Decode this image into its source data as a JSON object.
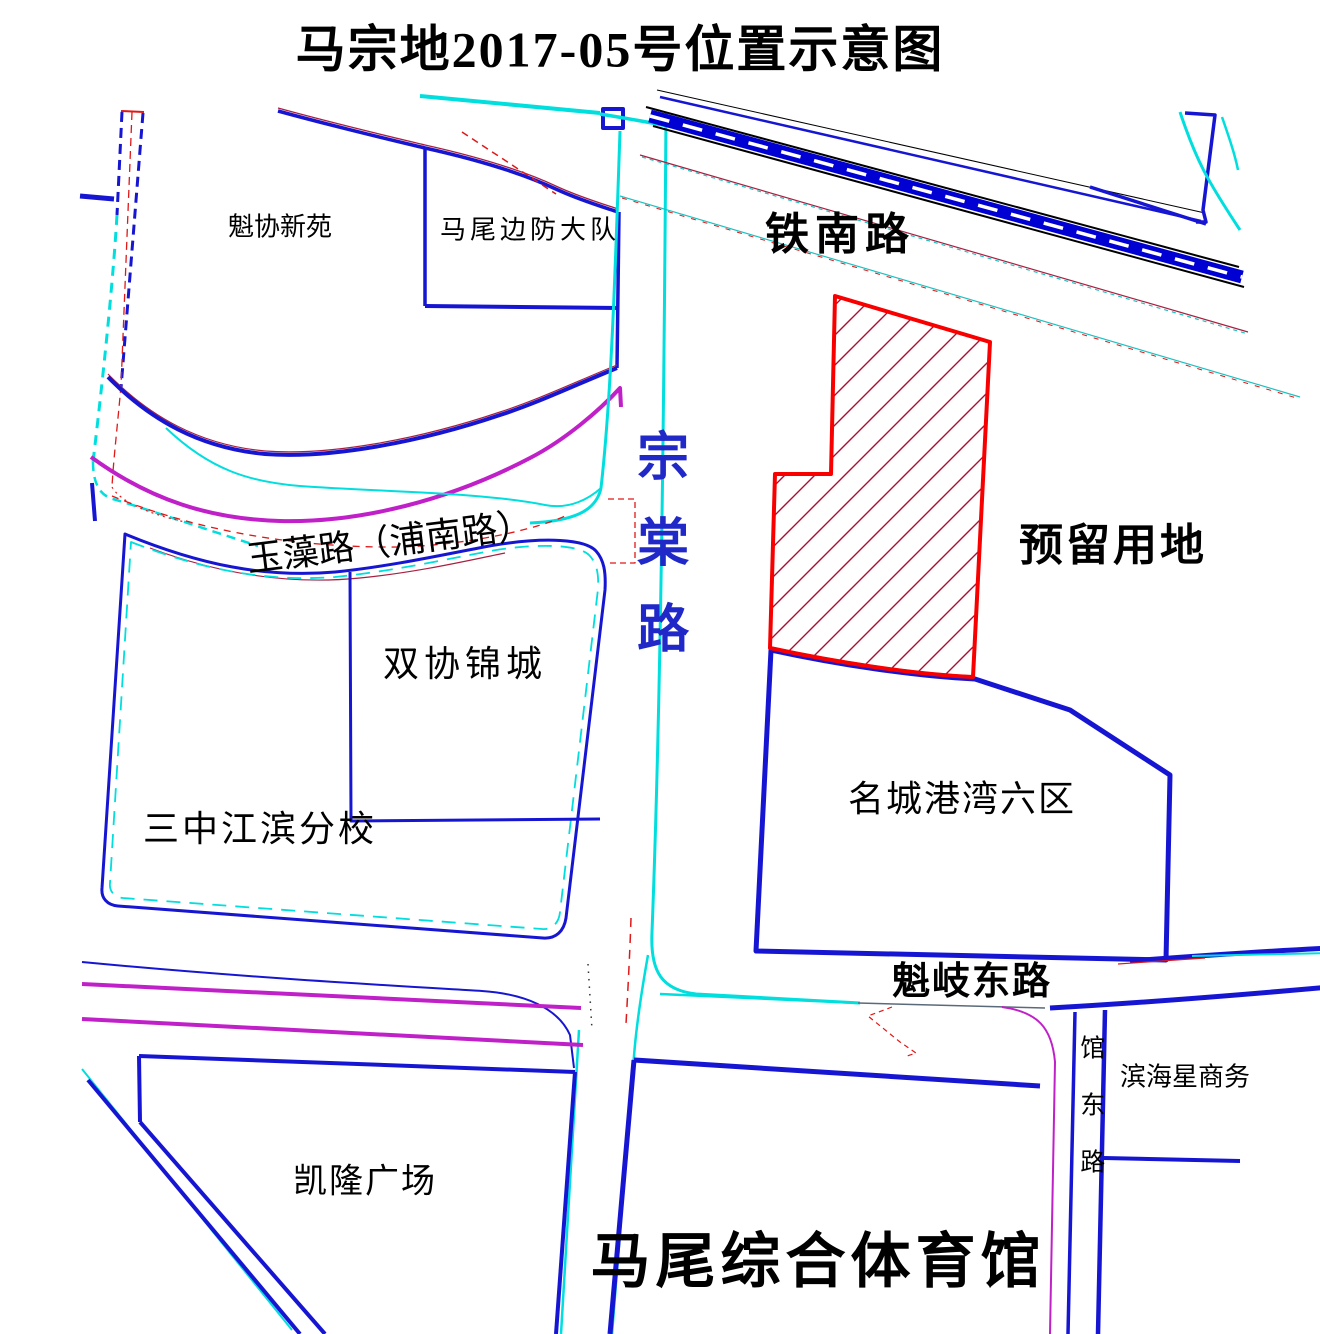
{
  "title": "马宗地2017-05号位置示意图",
  "labels": {
    "kuixie_xinyuan": "魁协新苑",
    "mawei_bianfang_dadui": "马尾边防大队",
    "tienan_lu": "铁南路",
    "yuliu_yongdi": "预留用地",
    "zongtang_lu": "宗棠路",
    "yuzao_lu": "玉藻路（浦南路）",
    "shuangxie_jincheng": "双协锦城",
    "sanzhong_jiangbin_fenxiao": "三中江滨分校",
    "mingcheng_gangwan_liuqu": "名城港湾六区",
    "kuiqi_dong_lu": "魁岐东路",
    "kailong_guangchang": "凯隆广场",
    "mawei_zonghe_tiyuguan": "马尾综合体育馆",
    "binhaixing_shangwu": "滨海星商务",
    "guandong_lu": "馆东路"
  },
  "colors": {
    "boundary_blue": "#1616d2",
    "railway_blue": "#0000d2",
    "road_cyan": "#00dede",
    "road_magenta": "#c020c8",
    "annotation_red": "#e01818",
    "parcel_outline": "#f80000",
    "parcel_hatch": "#a81030",
    "dark_red": "#a82040",
    "maroon": "#7a2058",
    "teal": "#20c0c0",
    "road_label_blue": "#2028c8"
  }
}
